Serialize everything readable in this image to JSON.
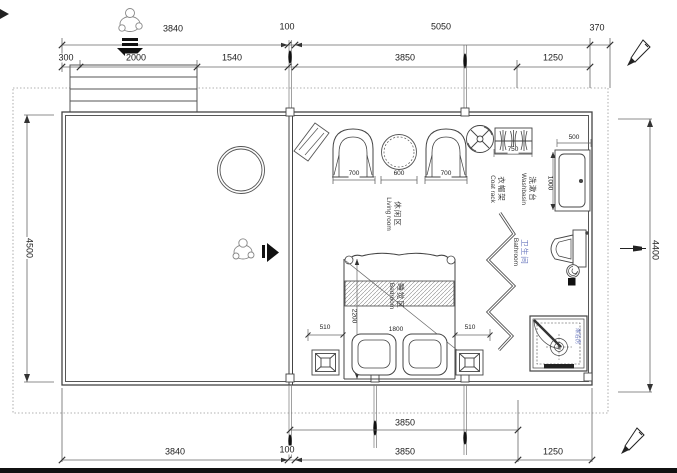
{
  "plan": {
    "dims": {
      "top_row1": [
        "3840",
        "100",
        "5050",
        "370"
      ],
      "top_row2": [
        "300",
        "2000",
        "1540",
        "3850",
        "1250"
      ],
      "left_height": "4500",
      "right_height": "4400",
      "bottom_inner": "3850",
      "bottom_row": [
        "3840",
        "100",
        "3850",
        "1250"
      ],
      "living_chair_left": "700",
      "living_table": "600",
      "living_chair_right": "700",
      "coat_rack_width": "750",
      "washbasin_width": "500",
      "washbasin_depth": "1000",
      "bed_side_left": "510",
      "bed_side_right": "510",
      "bed_width": "1800",
      "bed_length": "2200"
    },
    "rooms": {
      "living": {
        "zh": "休闲区",
        "en": "Living room"
      },
      "bedroom": {
        "zh": "睡觉区",
        "en": "Bedroom"
      },
      "bathroom": {
        "zh": "卫生间",
        "en": "Bathroom"
      },
      "washbasin": {
        "zh": "洗漱台",
        "en": "Washbasin"
      },
      "coat_rack": {
        "zh": "衣帽架",
        "en": "Coat rack"
      },
      "shower": {
        "zh": "淋浴房"
      }
    },
    "colors": {
      "line": "#4a4a4a",
      "accent_blue": "#6b79bf"
    }
  }
}
